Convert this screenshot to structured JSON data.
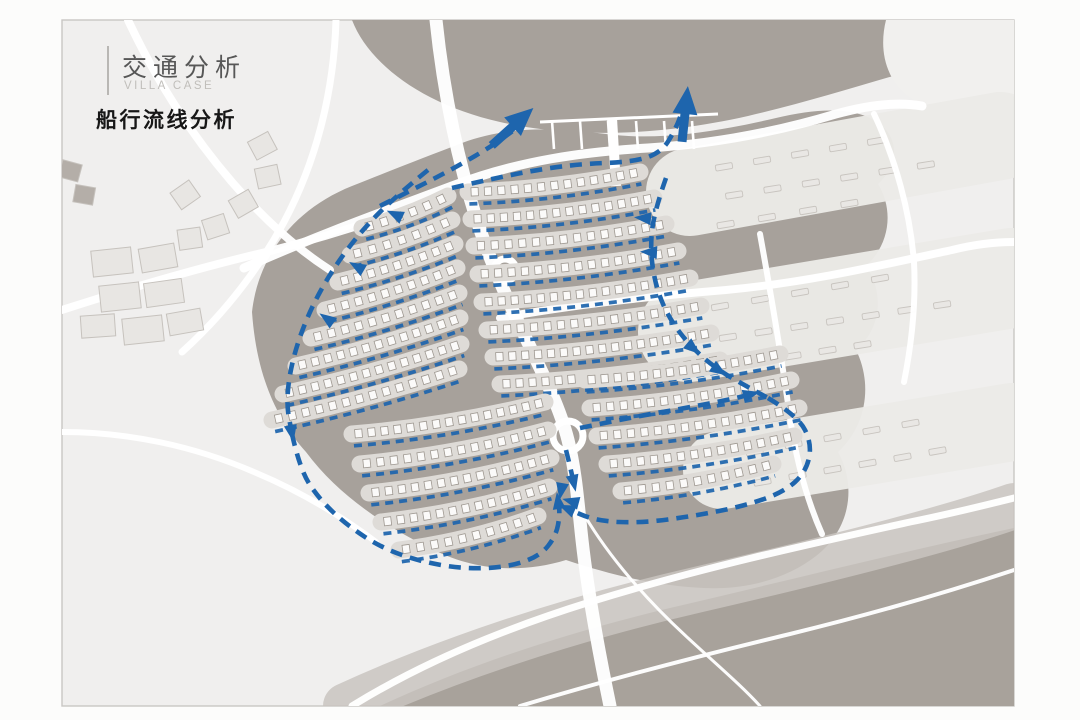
{
  "header": {
    "title": "交通分析",
    "subtitle": "VILLA CASE",
    "section": "船行流线分析"
  },
  "colors": {
    "page": "#fcfcfb",
    "slide": "#f0efee",
    "slide_border": "#c9c7c4",
    "land": "#a7a19b",
    "beach_dark": "#a8a29b",
    "beach_band": "#c9c4bf",
    "plate": "#ecebe8",
    "road": "#ffffff",
    "row_band": "#dedbd7",
    "house_fill": "#fbfaf9",
    "house_stroke": "#9e9891",
    "faint_house_fill": "#e9e7e4",
    "faint_house_stroke": "#c8c4bf",
    "building_fill": "#e8e6e3",
    "building_stroke": "#c6c2bd",
    "building_dark": "#b4aea8",
    "flow": "#1e65ad"
  },
  "map": {
    "shapes": [
      {
        "name": "water-top",
        "d": "M 352,20 C 368,62 420,104 500,122 C 580,140 668,134 748,116 C 800,104 852,88 900,74 C 944,62 984,54 1014,52 L 1014,20 Z",
        "fill": "#a7a19b",
        "opacity": 1
      },
      {
        "name": "corner-blob",
        "d": "M 886,20 C 878,52 886,88 922,104 C 952,117 990,112 1014,96 L 1014,20 Z",
        "fill": "#f1f0ee",
        "opacity": 1
      },
      {
        "name": "main-land",
        "d": "M 252,312 C 258,258 292,210 352,186 C 392,170 428,156 462,143 C 510,125 560,128 606,134 C 658,141 716,132 776,118 C 818,108 856,106 880,124 C 900,140 898,166 878,184 C 894,210 890,244 866,266 C 884,292 882,328 856,350 C 872,382 868,424 838,452 C 856,484 852,528 816,556 C 788,578 748,590 704,588 C 656,586 608,574 566,560 C 520,574 474,570 434,550 C 392,530 340,498 306,452 C 272,414 256,368 252,312 Z",
        "fill": "#a7a19b",
        "opacity": 1
      },
      {
        "name": "beach-dark",
        "d": "M 380,706 C 470,664 570,632 670,608 C 790,580 900,552 1014,528 L 1014,706 Z",
        "fill": "#a8a29b",
        "opacity": 1
      }
    ],
    "bands": [
      {
        "name": "beach-band",
        "d": "M 346,706 C 446,660 566,620 696,590 C 826,560 946,530 1014,506",
        "w": 46,
        "color": "#c9c4bf",
        "opacity": 0.85
      }
    ],
    "plates": [
      [
        690,
        192,
        1000,
        136,
        88
      ],
      [
        688,
        332,
        1012,
        278,
        100
      ],
      [
        722,
        470,
        1012,
        422,
        78
      ]
    ],
    "faint_rows": [
      [
        705,
        170,
        895,
        138
      ],
      [
        715,
        198,
        945,
        162
      ],
      [
        705,
        228,
        870,
        200
      ],
      [
        700,
        310,
        900,
        275
      ],
      [
        710,
        340,
        960,
        302
      ],
      [
        705,
        370,
        880,
        342
      ],
      [
        735,
        455,
        930,
        420
      ],
      [
        745,
        485,
        955,
        448
      ]
    ],
    "roads": [
      {
        "d": "M 244,268 C 320,234 388,210 452,186 C 520,160 584,152 648,148 C 712,144 776,132 836,114 C 872,104 900,102 922,106",
        "w": 9
      },
      {
        "d": "M 436,20 C 442,78 452,130 464,176 C 480,238 500,284 522,330 C 544,376 560,408 568,440 C 576,472 578,504 582,540 C 588,594 598,648 610,706",
        "w": 13
      },
      {
        "d": "M 500,318 C 576,304 652,296 726,290 C 812,282 886,264 952,250 C 976,244 998,242 1014,242",
        "w": 8
      },
      {
        "d": "M 760,234 C 772,300 782,360 790,418 C 796,458 806,498 822,534",
        "w": 6
      },
      {
        "d": "M 874,114 C 896,160 910,212 914,262 C 916,300 912,342 904,382",
        "w": 6
      },
      {
        "d": "M 352,706 C 420,664 500,630 590,602 C 700,568 810,544 910,522 C 950,514 990,504 1014,498",
        "w": 7
      },
      {
        "d": "M 520,706 C 600,682 690,658 790,634 C 880,612 960,588 1014,570",
        "w": 4
      },
      {
        "d": "M 576,500 C 600,546 640,594 688,638 C 716,664 742,686 760,706",
        "w": 3
      },
      {
        "d": "M 128,20 C 158,84 198,146 248,200 C 274,228 302,252 330,270",
        "w": 8
      },
      {
        "d": "M 62,310 C 130,288 198,268 266,252 C 314,240 360,226 404,210",
        "w": 8
      },
      {
        "d": "M 336,20 C 334,88 318,158 284,222 C 258,270 224,314 182,352",
        "w": 7
      },
      {
        "d": "M 62,432 C 128,432 194,446 254,472 C 302,492 344,518 376,542",
        "w": 6
      }
    ],
    "circles": [
      [
        568,
        436,
        15
      ],
      [
        505,
        270,
        11
      ]
    ],
    "marina": {
      "bar": [
        540,
        122,
        718,
        114
      ],
      "finger_xs": [
        552,
        580,
        608,
        636,
        664,
        692
      ],
      "finger_len": 27,
      "trunk": [
        612,
        118,
        616,
        186
      ]
    },
    "buildings": {
      "squares": [
        [
          263,
          147,
          -28
        ],
        [
          268,
          178,
          -12
        ],
        [
          244,
          205,
          -30
        ],
        [
          216,
          228,
          -18
        ],
        [
          186,
          196,
          -35
        ],
        [
          190,
          240,
          -8
        ]
      ],
      "dark_squares": [
        [
          70,
          172,
          15
        ],
        [
          84,
          196,
          10
        ]
      ],
      "rects": [
        [
          112,
          262,
          40,
          26,
          -6
        ],
        [
          158,
          258,
          36,
          24,
          -10
        ],
        [
          120,
          297,
          40,
          26,
          -6
        ],
        [
          164,
          293,
          38,
          24,
          -8
        ],
        [
          143,
          330,
          40,
          26,
          -6
        ],
        [
          98,
          326,
          34,
          22,
          -4
        ],
        [
          185,
          322,
          34,
          22,
          -10
        ]
      ]
    },
    "clusters": [
      {
        "name": "northeast",
        "sag": 7,
        "rows": [
          [
            468,
            192,
            640,
            172
          ],
          [
            471,
            219,
            654,
            198
          ],
          [
            474,
            246,
            666,
            224
          ],
          [
            478,
            274,
            678,
            251
          ],
          [
            482,
            302,
            690,
            278
          ],
          [
            487,
            330,
            701,
            306
          ],
          [
            493,
            357,
            711,
            333
          ],
          [
            500,
            384,
            720,
            360
          ]
        ]
      },
      {
        "name": "northwest",
        "sag": 5,
        "rows": [
          [
            362,
            228,
            448,
            196
          ],
          [
            350,
            255,
            452,
            220
          ],
          [
            338,
            282,
            455,
            244
          ],
          [
            325,
            310,
            457,
            268
          ],
          [
            311,
            338,
            459,
            293
          ],
          [
            296,
            366,
            460,
            318
          ],
          [
            283,
            394,
            461,
            344
          ],
          [
            272,
            420,
            459,
            369
          ]
        ]
      },
      {
        "name": "southwest",
        "sag": 8,
        "rows": [
          [
            352,
            434,
            545,
            402
          ],
          [
            360,
            464,
            548,
            430
          ],
          [
            369,
            493,
            551,
            458
          ],
          [
            381,
            522,
            549,
            487
          ],
          [
            399,
            550,
            538,
            516
          ]
        ]
      },
      {
        "name": "southeast",
        "sag": 7,
        "rows": [
          [
            585,
            380,
            780,
            354
          ],
          [
            590,
            408,
            791,
            380
          ],
          [
            597,
            436,
            799,
            408
          ],
          [
            607,
            464,
            794,
            436
          ],
          [
            621,
            491,
            773,
            464
          ]
        ]
      }
    ],
    "routes": [
      {
        "name": "exit-northwest",
        "pts": [
          [
            380,
            206
          ],
          [
            420,
            186
          ],
          [
            458,
            166
          ],
          [
            492,
            146
          ],
          [
            514,
            130
          ]
        ],
        "arrow": "none"
      },
      {
        "name": "exit-north",
        "pts": [
          [
            452,
            188
          ],
          [
            512,
            174
          ],
          [
            576,
            164
          ],
          [
            634,
            162
          ],
          [
            662,
            152
          ],
          [
            676,
            128
          ],
          [
            682,
            112
          ]
        ],
        "arrow": "none"
      },
      {
        "name": "east-collector",
        "pts": [
          [
            666,
            178
          ],
          [
            654,
            212
          ],
          [
            650,
            250
          ],
          [
            656,
            288
          ],
          [
            670,
            320
          ],
          [
            692,
            348
          ],
          [
            718,
            370
          ],
          [
            746,
            386
          ],
          [
            768,
            398
          ]
        ],
        "arrow": "none"
      },
      {
        "name": "southeast-loop",
        "pts": [
          [
            768,
            398
          ],
          [
            798,
            416
          ],
          [
            812,
            444
          ],
          [
            806,
            472
          ],
          [
            784,
            492
          ],
          [
            744,
            506
          ],
          [
            694,
            516
          ],
          [
            642,
            523
          ],
          [
            596,
            521
          ],
          [
            566,
            508
          ]
        ],
        "arrow": "end"
      },
      {
        "name": "west-collector",
        "pts": [
          [
            428,
            170
          ],
          [
            396,
            196
          ],
          [
            362,
            230
          ],
          [
            332,
            270
          ],
          [
            308,
            314
          ],
          [
            292,
            360
          ],
          [
            286,
            402
          ],
          [
            292,
            434
          ]
        ],
        "arrow": "end"
      },
      {
        "name": "southwest-loop",
        "pts": [
          [
            292,
            434
          ],
          [
            300,
            470
          ],
          [
            320,
            500
          ],
          [
            348,
            526
          ],
          [
            382,
            548
          ],
          [
            422,
            562
          ],
          [
            466,
            569
          ],
          [
            508,
            567
          ],
          [
            540,
            556
          ],
          [
            556,
            536
          ],
          [
            560,
            514
          ],
          [
            558,
            500
          ]
        ],
        "arrow": "end"
      },
      {
        "name": "junction-north",
        "pts": [
          [
            566,
            450
          ],
          [
            570,
            466
          ],
          [
            574,
            484
          ]
        ],
        "arrow": "end"
      },
      {
        "name": "southeast-top",
        "pts": [
          [
            580,
            428
          ],
          [
            628,
            418
          ],
          [
            680,
            409
          ],
          [
            728,
            400
          ],
          [
            752,
            394
          ]
        ],
        "arrow": "end"
      }
    ],
    "small_arrows": [
      [
        394,
        214,
        205
      ],
      [
        356,
        266,
        210
      ],
      [
        326,
        318,
        215
      ],
      [
        642,
        218,
        185
      ],
      [
        648,
        252,
        183
      ],
      [
        694,
        349,
        40
      ],
      [
        720,
        371,
        33
      ],
      [
        561,
        492,
        100
      ],
      [
        570,
        501,
        195
      ]
    ],
    "big_arrows": [
      [
        520,
        120,
        -42
      ],
      [
        686,
        104,
        -84
      ]
    ]
  }
}
